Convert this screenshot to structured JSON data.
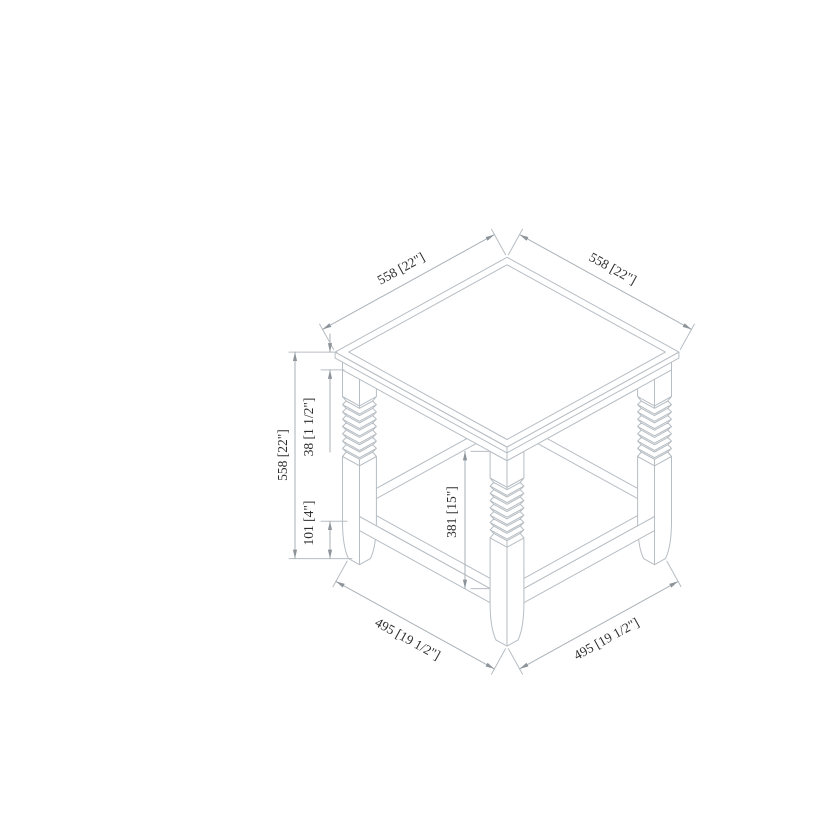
{
  "page": {
    "background_color": "#ffffff"
  },
  "drawing": {
    "type": "isometric dimension drawing",
    "subject": "square end table with beveled top, turned ribbed legs and lower shelf",
    "line_color": "#b6bdc3",
    "dimension_line_color": "#a9b1b7",
    "text_color": "#2f2f2f",
    "dimensions": [
      {
        "id": "top-width",
        "label": "558 [22\"]",
        "mm": 558,
        "inches": "22\"",
        "location": "top left edge of tabletop"
      },
      {
        "id": "top-depth",
        "label": "558 [22\"]",
        "mm": 558,
        "inches": "22\"",
        "location": "top right edge of tabletop"
      },
      {
        "id": "overall-height",
        "label": "558 [22\"]",
        "mm": 558,
        "inches": "22\"",
        "location": "left vertical, floor to tabletop"
      },
      {
        "id": "top-thickness",
        "label": "38 [1 1/2\"]",
        "mm": 38,
        "inches": "1 1/2\"",
        "location": "tabletop/apron thickness"
      },
      {
        "id": "shelf-clearance",
        "label": "381 [15\"]",
        "mm": 381,
        "inches": "15\"",
        "location": "underside of top to shelf surface"
      },
      {
        "id": "shelf-underside",
        "label": "101 [4\"]",
        "mm": 101,
        "inches": "4\"",
        "location": "floor to underside of shelf"
      },
      {
        "id": "base-width",
        "label": "495 [19 1/2\"]",
        "mm": 495,
        "inches": "19 1/2\"",
        "location": "bottom left, between feet"
      },
      {
        "id": "base-depth",
        "label": "495 [19 1/2\"]",
        "mm": 495,
        "inches": "19 1/2\"",
        "location": "bottom right, between feet"
      }
    ]
  }
}
